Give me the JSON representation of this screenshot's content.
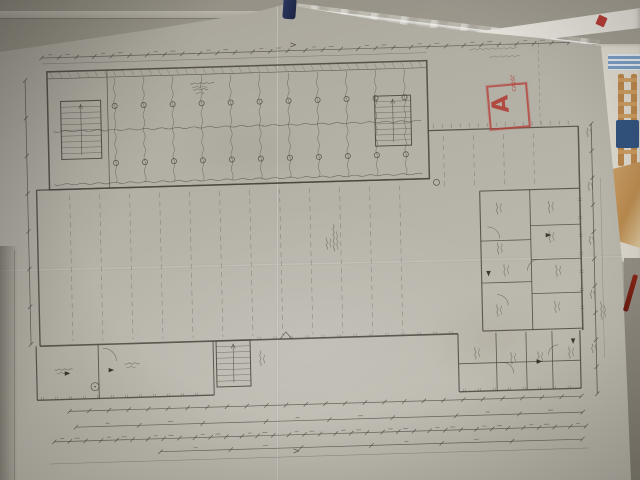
{
  "plan": {
    "north_arrow": ">",
    "stamp": {
      "letter": "A",
      "note": "część"
    },
    "line_color": "#4b4740",
    "arrow_fill": "#2b2822",
    "grid": {
      "top_chain_ticks": 30,
      "upper_columns": 11,
      "upper_block_rows": 2,
      "hall_columns": 12,
      "right_section_columns": 4,
      "bottom_chain_ticks": 34,
      "mid_chain_ticks": 26,
      "total_chain_ticks": 6,
      "right_chain_ticks": 10,
      "left_chain_ticks": 7,
      "stairs": 3,
      "column_circles": 22
    }
  },
  "colors": {
    "stamp_red": "#b5423b",
    "pencil_red": "#7c2014",
    "pen_cap_blue": "#232c4e",
    "paper": "#b4b1a7"
  }
}
